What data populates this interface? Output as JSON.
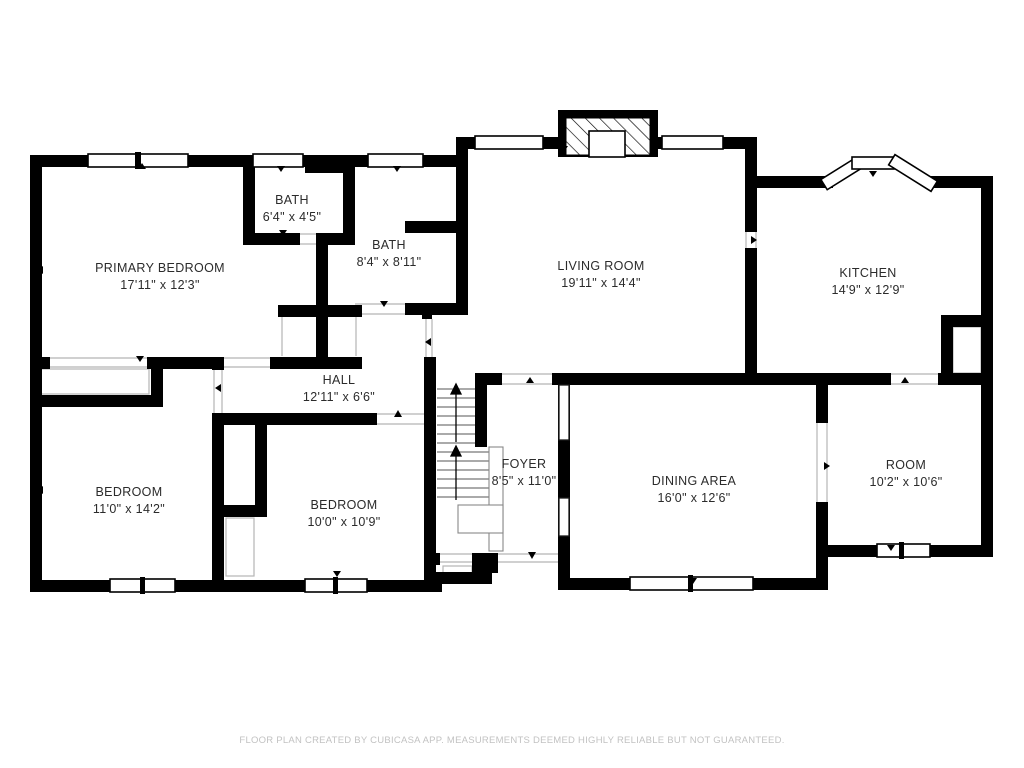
{
  "document": {
    "type": "floor-plan",
    "creator_note": "FLOOR PLAN CREATED BY CUBICASA APP. MEASUREMENTS DEEMED HIGHLY RELIABLE BUT NOT GUARANTEED."
  },
  "rooms": {
    "primary_bedroom": {
      "name": "PRIMARY BEDROOM",
      "dimensions": "17'11\" x 12'3\""
    },
    "bath_small": {
      "name": "BATH",
      "dimensions": "6'4\" x 4'5\""
    },
    "bath_large": {
      "name": "BATH",
      "dimensions": "8'4\" x 8'11\""
    },
    "living_room": {
      "name": "LIVING ROOM",
      "dimensions": "19'11\" x 14'4\""
    },
    "kitchen": {
      "name": "KITCHEN",
      "dimensions": "14'9\" x 12'9\""
    },
    "hall": {
      "name": "HALL",
      "dimensions": "12'11\" x 6'6\""
    },
    "bedroom_left": {
      "name": "BEDROOM",
      "dimensions": "11'0\" x 14'2\""
    },
    "bedroom_middle": {
      "name": "BEDROOM",
      "dimensions": "10'0\" x 10'9\""
    },
    "foyer": {
      "name": "FOYER",
      "dimensions": "8'5\" x 11'0\""
    },
    "dining_area": {
      "name": "DINING AREA",
      "dimensions": "16'0\" x 12'6\""
    },
    "room": {
      "name": "ROOM",
      "dimensions": "10'2\" x 10'6\""
    }
  },
  "footer": {
    "disclaimer": "FLOOR PLAN CREATED BY CUBICASA APP. MEASUREMENTS DEEMED HIGHLY RELIABLE BUT NOT GUARANTEED."
  },
  "colors": {
    "wall": "#000000",
    "background": "#ffffff",
    "label_text": "#2b2b2b",
    "footer_text": "#c2c2c2",
    "opening_line": "#b5b5b5"
  }
}
